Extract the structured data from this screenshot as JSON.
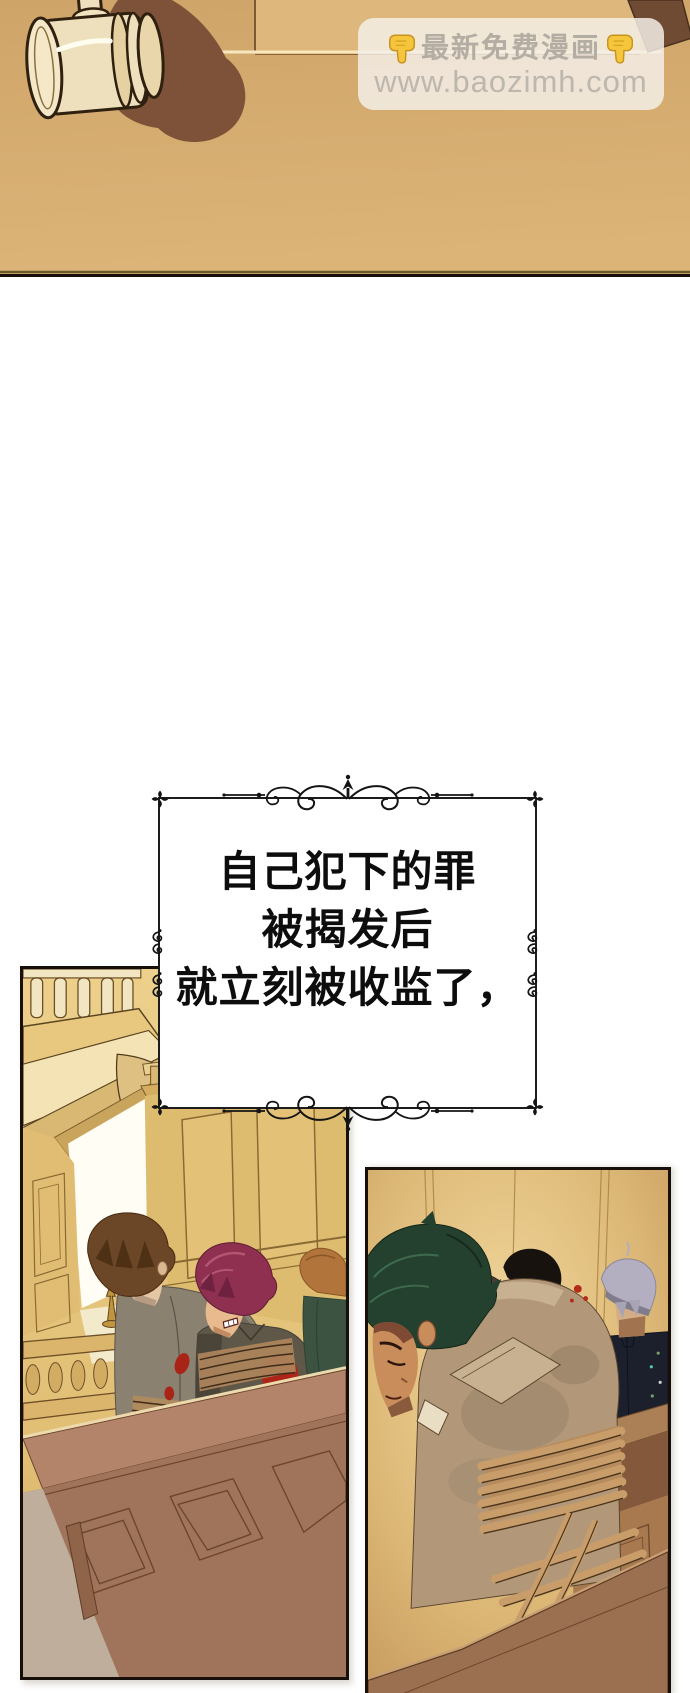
{
  "watermark": {
    "title": "最新免费漫画",
    "full_text": "👇最新免费漫画👇",
    "url": "www.baozimh.com",
    "left_icon": "pointing-down-hand-icon",
    "right_icon": "pointing-down-hand-icon"
  },
  "caption": {
    "line1": "自己犯下的罪",
    "line2": "被揭发后",
    "line3": "就立刻被收监了，"
  },
  "colors": {
    "background_tan": "#d3a76c",
    "panel_border": "#17100a",
    "caption_text": "#0d0d0d",
    "watermark_text": "#b3ada3",
    "blood_red": "#a82416",
    "wall_gold": "#e2c177",
    "wood_brown": "#a0745b",
    "rope_tan": "#c89d69"
  }
}
